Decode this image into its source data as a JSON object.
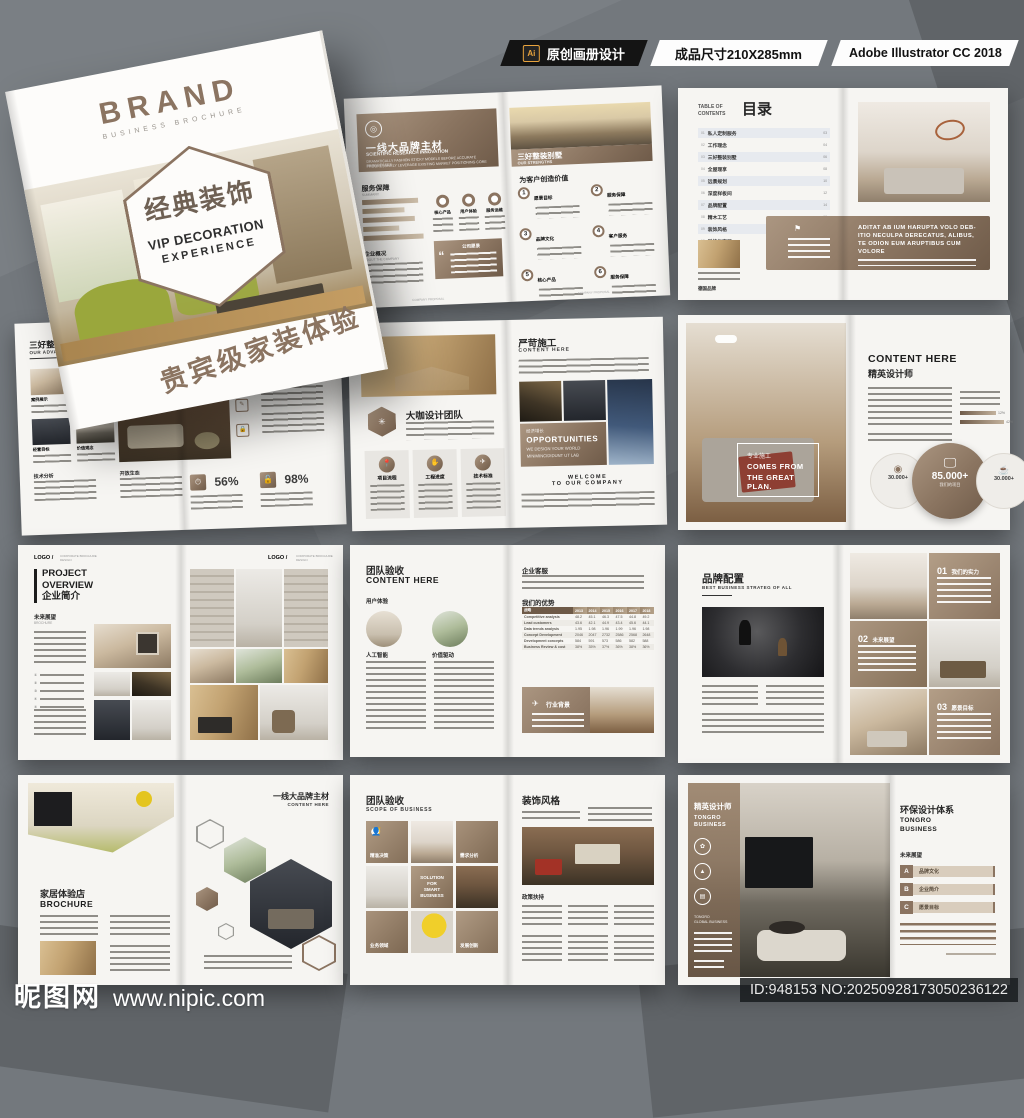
{
  "colors": {
    "accent": "#8b7461",
    "accent_dark": "#6f5b49",
    "page": "#f6f5f2",
    "background": "#73787d",
    "ai_yellow": "#e8a33d"
  },
  "top_bar": {
    "ai_icon": "Ai",
    "ai_label": "原创画册设计",
    "size_label": "成品尺寸210X285mm",
    "software_label": "Adobe Illustrator CC 2018"
  },
  "cover": {
    "brand": "BRAND",
    "brand_sub": "BUSINESS  BROCHURE",
    "hex_title": "经典装饰",
    "hex_line2": "VIP DECORATION",
    "hex_line3": "EXPERIENCE",
    "tagline": "贵宾级家装体验"
  },
  "spreads": {
    "materials": {
      "left_title": "一线大品牌主材",
      "left_sub": "SCIENTIFIC RESEARCH INNOVATION",
      "left_desc1": "DRAMATICALLY FASHION STICKY MODELS BEFORE ACCURATE PROGRESSES",
      "left_desc2": "PROGRESSIVELY LEVERAGE EXISTING MARKET POSITIONING CORE",
      "right_title": "三好整装别墅",
      "right_sub": "OUR STRENGTHS",
      "service_title": "服务保障",
      "service_sub": "SUMMARY",
      "stats": [
        "核心产品",
        "用户体验",
        "服务运维"
      ],
      "quote_title": "公司愿景",
      "about_title": "企业概况",
      "about_sub": "ABOUT THE COMPANY",
      "value_title": "为客户创造价值",
      "value_items": [
        {
          "num": "1",
          "label": "愿景目标"
        },
        {
          "num": "2",
          "label": "服务保障"
        },
        {
          "num": "3",
          "label": "品牌文化"
        },
        {
          "num": "4",
          "label": "客户服务"
        },
        {
          "num": "5",
          "label": "核心产品"
        },
        {
          "num": "6",
          "label": "服务保障"
        }
      ],
      "footer_label": "COMPANY PROPOSAL"
    },
    "toc": {
      "eyebrow1": "TABLE OF",
      "eyebrow2": "CONTENTS",
      "title": "目录",
      "items": [
        {
          "num": "01",
          "label": "私人定制服务",
          "page": "03"
        },
        {
          "num": "02",
          "label": "工作理念",
          "page": "04"
        },
        {
          "num": "03",
          "label": "三好整装别墅",
          "page": "06"
        },
        {
          "num": "04",
          "label": "全屋理享",
          "page": "08"
        },
        {
          "num": "05",
          "label": "远景规划",
          "page": "10"
        },
        {
          "num": "06",
          "label": "深度样板间",
          "page": "12"
        },
        {
          "num": "07",
          "label": "品牌配置",
          "page": "14"
        },
        {
          "num": "08",
          "label": "精木工艺",
          "page": "16"
        },
        {
          "num": "09",
          "label": "装饰风格",
          "page": "18"
        },
        {
          "num": "10",
          "label": "科技化家居",
          "page": "20"
        }
      ],
      "brand_label": "德国品牌",
      "banner_line1": "ADITAT AB IUM HARUPTA VOLO DEB-",
      "banner_line2": "ITIO NECULPA DERECATUS, ALIBUS,",
      "banner_line3": "TE ODION EUM ARUPTIBUS CUM",
      "banner_line4": "VOLORE"
    },
    "advantages": {
      "title": "三好整装别墅",
      "sub": "OUR ADVANTAGES",
      "thumbs": [
        "案例展示",
        "未来展望",
        "经营目标",
        "价值观念"
      ],
      "right_section": "产品运营",
      "stat1": "56%",
      "stat2": "98%",
      "bottom1": "技术分析",
      "bottom2": "开放生态"
    },
    "team": {
      "left_title": "大咖设计团队",
      "columns": [
        "项目流程",
        "工程进度",
        "技术标准"
      ],
      "right_title": "严苛施工",
      "right_sub": "CONTENT HERE",
      "opp_label": "经济增长",
      "opp_title": "OPPORTUNITIES",
      "opp_sub1": "WE DESIGN YOUR WORLD",
      "opp_sub2": "MINIMINCIDIDUNT UT LAB",
      "welcome1": "WELCOME",
      "welcome2": "TO OUR COMPANY"
    },
    "elite": {
      "overlay1": "专业施工",
      "overlay2": "COMES FROM",
      "overlay3": "THE GREAT PLAN.",
      "right_title": "CONTENT HERE",
      "right_sub": "精英设计师",
      "bar1": "12%",
      "bar2": "42%",
      "circle_left": "30.000+",
      "circle_main": "85.000+",
      "circle_main_sub": "我们的项目",
      "circle_right": "30.000+"
    },
    "overview": {
      "logo": "LOGO /",
      "logo_note": "CORPORATE BROCHURE DESIGN",
      "title1": "PROJECT",
      "title2": "OVERVIEW",
      "title3": "企业简介",
      "section": "未来展望",
      "section_sub": "BROCHURE"
    },
    "acceptance": {
      "title": "团队验收",
      "sub": "CONTENT HERE",
      "section1": "用户体验",
      "circle1": "人工智能",
      "circle2": "价值驱动",
      "right_section1": "企业客服",
      "right_section2": "我们的优势",
      "table": {
        "first_col": "战略",
        "years": [
          "2013",
          "2014",
          "2015",
          "2016",
          "2017",
          "2018"
        ],
        "rows": [
          {
            "label": "Competitive analysis",
            "values": [
              "48.2",
              "45.1",
              "46.3",
              "47.5",
              "44.8",
              "49.2"
            ]
          },
          {
            "label": "Lead customers",
            "values": [
              "43.6",
              "42.1",
              "44.9",
              "43.4",
              "45.6",
              "44.1"
            ]
          },
          {
            "label": "Data trends analysis",
            "values": [
              "1.95",
              "1.98",
              "1.96",
              "1.99",
              "1.96",
              "1.98"
            ]
          },
          {
            "label": "Concept Development",
            "values": [
              "2046",
              "2047",
              "2732",
              "2586",
              "2568",
              "2648"
            ]
          },
          {
            "label": "Development concepts",
            "values": [
              "584",
              "591",
              "573",
              "586",
              "582",
              "588"
            ]
          },
          {
            "label": "Business Review & cost",
            "values": [
              "38%",
              "35%",
              "37%",
              "36%",
              "38%",
              "36%"
            ]
          }
        ]
      },
      "banner": "行业背景"
    },
    "config": {
      "title": "品牌配置",
      "sub": "BEST BUSINESS STRATEG OF ALL",
      "items": [
        {
          "num": "01",
          "label": "我们的实力"
        },
        {
          "num": "02",
          "label": "未来展望"
        },
        {
          "num": "03",
          "label": "愿景目标"
        }
      ]
    },
    "store": {
      "title": "家居体验店",
      "sub": "BROCHURE",
      "right_title": "一线大品牌主材",
      "right_sub": "CONTENT HERE"
    },
    "scope": {
      "title": "团队验收",
      "sub": "SCOPE OF BUSINESS",
      "tile1": "精准决策",
      "tile2": "需求分析",
      "tile_center1": "SOLUTION",
      "tile_center2": "FOR",
      "tile_center3": "SMART",
      "tile_center4": "BUSINESS",
      "tile3": "业务领域",
      "tile4": "发展创新",
      "right_title": "装饰风格",
      "right_section": "政策扶持"
    },
    "tongro": {
      "side_title": "精英设计师",
      "side_sub1": "TONGRO",
      "side_sub2": "BUSINESS",
      "side_small1": "TONGRO",
      "side_small2": "GLOBAL BUSINESS",
      "right_title": "环保设计体系",
      "right_sub1": "TONGRO",
      "right_sub2": "BUSINESS",
      "section": "未来展望",
      "tags": [
        {
          "key": "A",
          "label": "品牌文化"
        },
        {
          "key": "B",
          "label": "企业简介"
        },
        {
          "key": "C",
          "label": "愿景目标"
        }
      ]
    }
  },
  "watermark": {
    "site": "昵图网",
    "url": "www.nipic.com",
    "id_text": "ID:948153 NO:20250928173050236122"
  }
}
